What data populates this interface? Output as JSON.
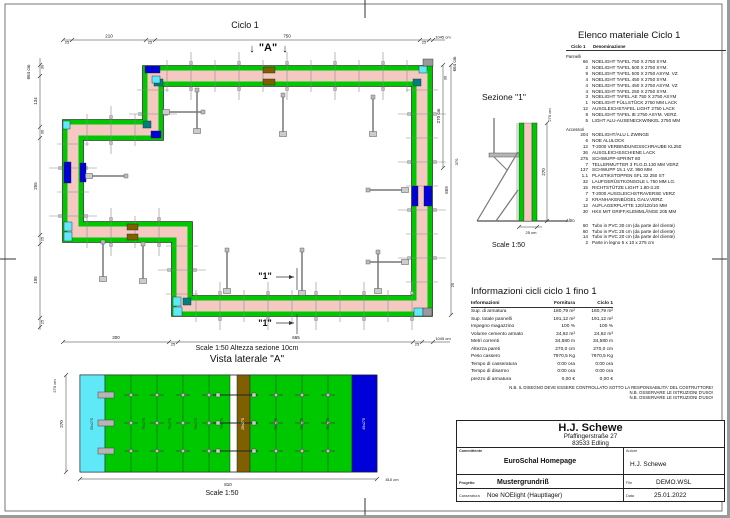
{
  "colors": {
    "green": "#00C800",
    "pink": "#F5C8C2",
    "cyan": "#5FE8F8",
    "blue": "#0000D8",
    "teal": "#007F7F",
    "brown": "#7F6000",
    "gray2": "#9a9a9a",
    "tie": "#8a8a8a",
    "ink": "#111111"
  },
  "plan": {
    "title": "Ciclo 1",
    "marker_a": "\"A\"",
    "marker_a_arrow": "↓",
    "marker_1": "\"1\"",
    "dims_top": [
      "25",
      "210",
      "25",
      "750",
      "25",
      "1045 cm"
    ],
    "dims_left": [
      "30",
      "134",
      "30",
      "255",
      "25",
      "195",
      "25",
      "664 cm"
    ],
    "dims_bottom": [
      "300",
      "25",
      "665",
      "25",
      "1045 cm"
    ],
    "dims_right": [
      "30",
      "664 cm",
      "270 cm",
      "370",
      "659",
      "25"
    ]
  },
  "sezione": {
    "title": "Sezione  \"1\"",
    "scale": "Scale 1:50",
    "dims": [
      "270 cm",
      "270",
      "25 cm"
    ]
  },
  "vista": {
    "scale_note": "Scale 1:50   Altezza sezione 10cm",
    "title": "Vista laterale  \"A\"",
    "scale": "Scale 1:50",
    "dims": [
      "270 cm",
      "270",
      "810",
      "810 cm"
    ],
    "panels": {
      "left": "50x275",
      "mid": "75x275",
      "fill": "25x275",
      "right": "45x275"
    }
  },
  "material_list": {
    "title": "Elenco materiale  Ciclo 1",
    "col_qty": "Ciclo 1",
    "col_name": "Denominazione",
    "groups": [
      {
        "name": "Pannelli",
        "items": [
          [
            "66",
            "NOELIGHT TAFEL 750 X 2750 SYM."
          ],
          [
            "2",
            "NOELIGHT TAFEL 500 X 2750 SYM."
          ],
          [
            "9",
            "NOELIGHT TAFEL 500 X 2750 ASYM. VZ"
          ],
          [
            "4",
            "NOELIGHT TAFEL 450 X 2750 SYM."
          ],
          [
            "4",
            "NOELIGHT TAFEL 450 X 2750 ASYM. VZ"
          ],
          [
            "4",
            "NOELIGHT TAFEL 250 X 2750 SYM."
          ],
          [
            "3",
            "NOELIGHT TAFEL AE 750 X 2750 ASYM"
          ],
          [
            "1",
            "NOELIGHT FÜLLSTÜCK 2750 MM LACK"
          ],
          [
            "12",
            "AUSGLEICHSTAFEL LIGHT 2750 LACK"
          ],
          [
            "8",
            "NOELIGHT TAFEL IE 2750 ASYM. VERZ."
          ],
          [
            "5",
            "LIGHT ALU-AUSENECKWINKEL 2750 MM"
          ]
        ]
      },
      {
        "name": "Accessori",
        "items": [
          [
            "204",
            "NOELIGHT/ALU L ZWINGE"
          ],
          [
            "6",
            "NOE ALULOCK"
          ],
          [
            "12",
            "T-2000 VERBINDUNGSSCHRAUBE KL250"
          ],
          [
            "36",
            "AUSGLEICHSSCHIENE LACK"
          ],
          [
            "275",
            "SCHWUPP-SPRINT 80"
          ],
          [
            "7",
            "TELLERMUTTER 3 FLG.D.130 MM VERZ"
          ],
          [
            "137",
            "SCHWUPP 15.1 VZ. 950 MM"
          ],
          [
            "1.1",
            "PLASTIKSTOPFEN SFL 32 250 ST"
          ],
          [
            "32",
            "LAUFGERÜSTKONSOLE L 750 MM LG."
          ],
          [
            "15",
            "RICHTSTÜTZE LIGHT 1.80-3.20"
          ],
          [
            "7",
            "T-2000 AUSGLEICHSTRAVERSE VERZ"
          ],
          [
            "2",
            "KRANHAKENBÜGEL GALV.VERZ."
          ],
          [
            "12",
            "AUFLAGERPLATTE 120/120/10 MM"
          ],
          [
            "30",
            "HKS MIT GRIFF,KLEMMLÄNGE 205 MM"
          ]
        ]
      },
      {
        "name": "Altro",
        "items": [
          [
            "60",
            "Tubo in PVC 30 cm (da parte del cliente)"
          ],
          [
            "60",
            "Tubo in PVC 25 cm (da parte del cliente)"
          ],
          [
            "14",
            "Tubo in PVC 20 cm (da parte del cliente)"
          ],
          [
            "2",
            "Parte in legno 5 x 10 x 275 cm"
          ]
        ]
      }
    ]
  },
  "info_table": {
    "title": "Informazioni cicli  ciclo 1 fino 1",
    "headers": [
      "Informazioni",
      "Fornitura",
      "Ciclo 1"
    ],
    "rows": [
      [
        "Sup. di armatura",
        "180,79 m²",
        "180,79 m²"
      ],
      [
        "Sup. totale pannelli",
        "191,12 m²",
        "191,12 m²"
      ],
      [
        "Impegno magazzino",
        "100 %",
        "100 %"
      ],
      [
        "Volume cemento armato",
        "24,62 m³",
        "24,62 m³"
      ],
      [
        "Metri correnti",
        "34,580 m",
        "34,580 m"
      ],
      [
        "Altezza pareti",
        "270,0 cm",
        "270,0 cm"
      ],
      [
        "Peso cassero",
        "7970,5 Kg",
        "7970,5 Kg"
      ],
      [
        "Tempo di casseratura",
        "0:00 ora",
        "0:00 ora"
      ],
      [
        "Tempo di disarmo",
        "0:00 ora",
        "0:00 ora"
      ],
      [
        "prezzo di armatura",
        "0,00 €",
        "0,00 €"
      ]
    ]
  },
  "notes": [
    "N.B. IL DISEGNO DEVE ESSERE CONTROLLATO SOTTO LA RESPONSABILITA' DEL COSTRUTTORE!",
    "N.B. OSSERVARE LE ISTRUZIONI D'USO!",
    "N.B. OSSERVARE LE ISTRUZIONI D'USO!"
  ],
  "title_block": {
    "company": "H.J. Schewe",
    "address1": "Pfaffingerstraße 27",
    "address2": "83533 Edling",
    "committente_label": "Committente",
    "committente": "EuroSchal Homepage",
    "autore_label": "Autore",
    "autore": "H.J. Schewe",
    "progetto_label": "Progetto",
    "progetto": "Mustergrundriß",
    "file_label": "File",
    "file": "DEMO.WSL",
    "casseratura_label": "Casseratura",
    "casseratura": "Noe NOElight (Hauptlager)",
    "data_label": "Data",
    "data": "25.01.2022"
  }
}
